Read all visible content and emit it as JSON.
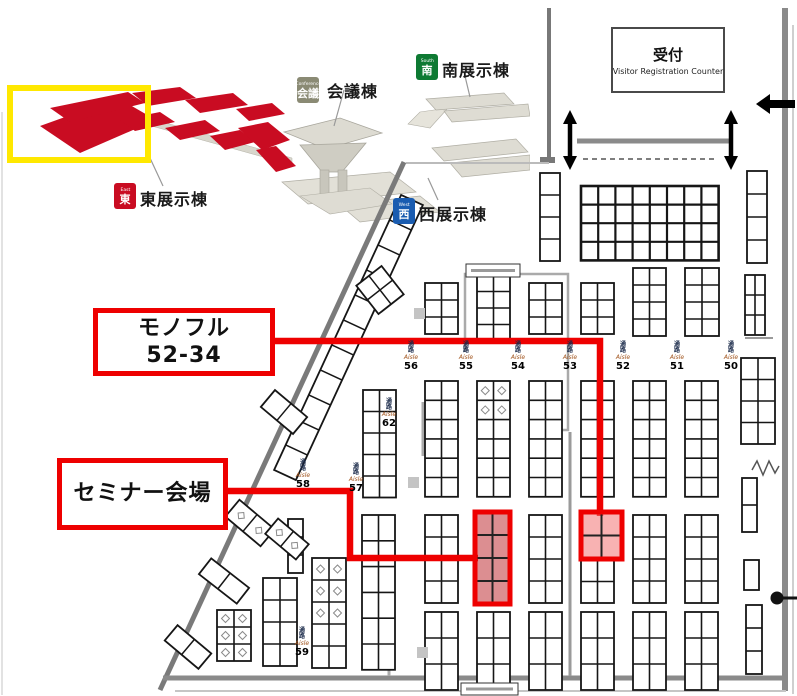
{
  "accent": "#ee0000",
  "overview": {
    "highlight_color": "#ffe800",
    "hall_red": "#c90c22",
    "labels": {
      "conference": "会議棟",
      "south": "南展示棟",
      "east": "東展示棟",
      "west": "西展示棟"
    },
    "badges": {
      "conference": {
        "en": "Conference",
        "jp": "会議",
        "color": "#8a8a74"
      },
      "south": {
        "en": "South",
        "jp": "南",
        "color": "#0e7a33"
      },
      "east": {
        "en": "East",
        "jp": "東",
        "color": "#c90c22"
      },
      "west": {
        "en": "West",
        "jp": "西",
        "color": "#1a5cb0"
      }
    }
  },
  "registration": {
    "title": "受付",
    "subtitle": "Visitor Registration Counter"
  },
  "callouts": {
    "monoful": {
      "line1": "モノフル",
      "line2": "52-34"
    },
    "seminar": {
      "line1": "セミナー会場"
    }
  },
  "aisle_word_jp": "通路",
  "aisle_word_en": "Aisle",
  "aisles": [
    {
      "num": "62",
      "x": 389,
      "y": 399
    },
    {
      "num": "56",
      "x": 411,
      "y": 342
    },
    {
      "num": "55",
      "x": 466,
      "y": 342
    },
    {
      "num": "54",
      "x": 518,
      "y": 342
    },
    {
      "num": "53",
      "x": 570,
      "y": 342
    },
    {
      "num": "52",
      "x": 623,
      "y": 342
    },
    {
      "num": "51",
      "x": 677,
      "y": 342
    },
    {
      "num": "50",
      "x": 731,
      "y": 342
    },
    {
      "num": "58",
      "x": 303,
      "y": 460
    },
    {
      "num": "57",
      "x": 356,
      "y": 464
    },
    {
      "num": "59",
      "x": 302,
      "y": 628
    }
  ],
  "floor": {
    "walls": [
      [
        549,
        8,
        549,
        160,
        4,
        "#787878"
      ],
      [
        540,
        160,
        555,
        160,
        6,
        "#787878"
      ],
      [
        785,
        8,
        785,
        691,
        6,
        "#8a8a8a"
      ],
      [
        793,
        25,
        793,
        694,
        2,
        "#cfcfcf"
      ],
      [
        577,
        141,
        729,
        141,
        5,
        "#8a8a8a"
      ],
      [
        406,
        163,
        549,
        163,
        2,
        "#bbbbbb"
      ],
      [
        404,
        162,
        160,
        690,
        5,
        "#7a7a7a"
      ],
      [
        163,
        678,
        784,
        678,
        5,
        "#8a8a8a"
      ],
      [
        175,
        691,
        786,
        691,
        2,
        "#c5c5c5"
      ],
      [
        570,
        432,
        570,
        676,
        3,
        "#9a9a9a"
      ],
      [
        745,
        338,
        773,
        338,
        2,
        "#9a9a9a"
      ],
      [
        2,
        112,
        2,
        695,
        2,
        "#e2e2e2"
      ],
      [
        423,
        402,
        423,
        456,
        3,
        "#ababab"
      ],
      [
        389,
        612,
        389,
        676,
        3,
        "#ababab"
      ]
    ],
    "dashed": [
      583,
      159,
      718,
      159
    ],
    "bracket": [
      [
        465,
        352
      ],
      [
        465,
        274
      ],
      [
        568,
        274
      ],
      [
        568,
        430
      ],
      [
        538,
        430
      ]
    ],
    "blocks": [
      [
        540,
        173,
        1,
        4,
        20,
        22,
        0
      ],
      [
        581,
        186,
        8,
        4,
        17.2,
        18.6,
        1
      ],
      [
        747,
        171,
        1,
        4,
        20,
        23,
        0
      ],
      [
        425,
        283,
        2,
        3,
        16.5,
        17,
        0
      ],
      [
        477,
        275,
        2,
        4,
        16.5,
        16.5,
        0
      ],
      [
        529,
        283,
        2,
        3,
        16.5,
        17,
        0
      ],
      [
        581,
        283,
        2,
        3,
        16.5,
        17,
        0
      ],
      [
        633,
        268,
        2,
        4,
        16.5,
        17,
        0
      ],
      [
        685,
        268,
        2,
        4,
        17,
        17,
        0
      ],
      [
        745,
        275,
        2,
        3,
        10,
        20,
        0
      ],
      [
        363,
        390,
        2,
        5,
        16.5,
        21.5,
        0
      ],
      [
        425,
        381,
        2,
        6,
        16.5,
        19.3,
        0
      ],
      [
        477,
        381,
        2,
        6,
        16.5,
        19.3,
        3
      ],
      [
        529,
        381,
        2,
        6,
        16.5,
        19.3,
        0
      ],
      [
        581,
        381,
        2,
        6,
        16.5,
        19.3,
        0
      ],
      [
        633,
        381,
        2,
        6,
        16.5,
        19.3,
        0
      ],
      [
        685,
        381,
        2,
        6,
        16.5,
        19.3,
        0
      ],
      [
        741,
        358,
        2,
        4,
        17,
        21.5,
        0
      ],
      [
        362,
        515,
        2,
        6,
        16.5,
        25.8,
        0
      ],
      [
        425,
        515,
        2,
        4,
        16.5,
        22,
        0
      ],
      [
        529,
        515,
        2,
        4,
        16.5,
        22,
        0
      ],
      [
        581,
        560,
        2,
        2,
        16.5,
        21.5,
        0
      ],
      [
        633,
        515,
        2,
        4,
        16.5,
        22,
        0
      ],
      [
        685,
        515,
        2,
        4,
        16.5,
        22,
        0
      ],
      [
        742,
        478,
        1,
        2,
        15,
        27,
        0
      ],
      [
        744,
        560,
        1,
        1,
        15,
        30,
        0
      ],
      [
        746,
        605,
        1,
        3,
        16,
        23,
        0
      ],
      [
        425,
        612,
        2,
        3,
        16.5,
        26,
        0
      ],
      [
        477,
        612,
        2,
        3,
        16.5,
        26,
        0
      ],
      [
        529,
        612,
        2,
        3,
        16.5,
        26,
        0
      ],
      [
        581,
        612,
        2,
        3,
        16.5,
        26,
        0
      ],
      [
        633,
        612,
        2,
        3,
        16.5,
        26,
        0
      ],
      [
        685,
        612,
        2,
        3,
        16.5,
        26,
        0
      ],
      [
        263,
        578,
        2,
        4,
        17,
        22,
        0
      ],
      [
        312,
        558,
        2,
        5,
        17,
        22,
        4
      ],
      [
        288,
        519,
        1,
        3,
        15,
        18,
        0
      ],
      [
        217,
        610,
        2,
        3,
        17,
        17,
        2
      ]
    ],
    "ladder": {
      "p1": [
        412,
        200
      ],
      "p2": [
        285,
        475
      ],
      "w": 24,
      "rungs": 11
    },
    "slanted": [
      [
        380,
        290,
        32,
        36,
        -38,
        2,
        2,
        0
      ],
      [
        284,
        412,
        22,
        42,
        -50,
        1,
        2,
        0
      ],
      [
        250,
        523,
        22,
        46,
        -50,
        1,
        2,
        1
      ],
      [
        287,
        539,
        20,
        40,
        -50,
        1,
        2,
        1
      ],
      [
        224,
        581,
        20,
        48,
        -52,
        1,
        2,
        0
      ],
      [
        188,
        647,
        20,
        44,
        -50,
        1,
        2,
        0
      ]
    ],
    "pillars": [
      [
        414,
        308
      ],
      [
        408,
        477
      ],
      [
        417,
        647
      ]
    ],
    "info_boxes": [
      [
        466,
        264,
        54,
        13
      ],
      [
        461,
        683,
        57,
        12
      ]
    ],
    "routes": [
      [
        [
          275,
          341
        ],
        [
          600,
          341
        ],
        [
          600,
          516
        ]
      ],
      [
        [
          228,
          491
        ],
        [
          350,
          491
        ],
        [
          350,
          558
        ],
        [
          478,
          558
        ]
      ]
    ],
    "highlights": [
      {
        "id": "seminar-venue-booth",
        "x": 475,
        "y": 512,
        "w": 35,
        "h": 92,
        "cols": 2,
        "rows": 4,
        "fill": "rgba(185,30,35,0.50)"
      },
      {
        "id": "booth-52-34",
        "x": 581,
        "y": 512,
        "w": 41,
        "h": 47,
        "cols": 2,
        "rows": 2,
        "fill": "rgba(242,115,115,0.55)"
      }
    ],
    "double_arrows": [
      [
        570,
        110
      ],
      [
        731,
        110
      ]
    ],
    "left_arrow": {
      "tip": [
        756,
        104
      ],
      "tail": [
        795,
        104
      ]
    },
    "door_dot": {
      "x": 777,
      "y": 598
    },
    "zigzag": [
      [
        752,
        470
      ],
      [
        757,
        461
      ],
      [
        763,
        475
      ],
      [
        769,
        461
      ],
      [
        775,
        473
      ],
      [
        779,
        466
      ]
    ]
  }
}
